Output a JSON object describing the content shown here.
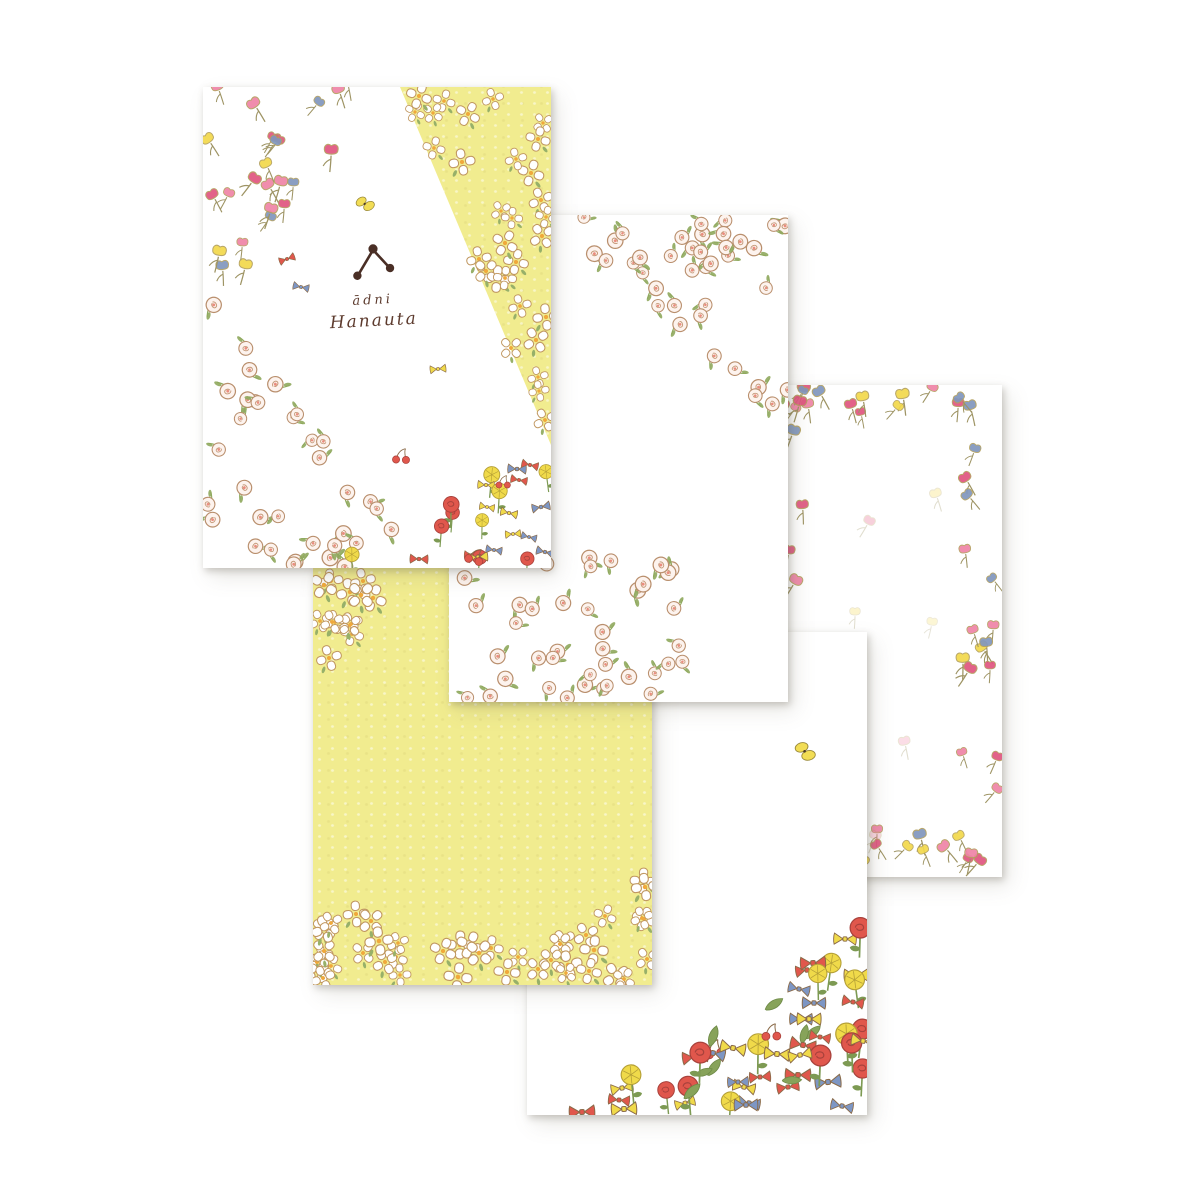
{
  "page": {
    "width": 1200,
    "height": 1200,
    "background": "#ffffff"
  },
  "brand": {
    "name_line1": "ādni",
    "name_line2": "Hanauta"
  },
  "palette": {
    "paper_yellow": "#f1ec8f",
    "text_brown": "#5d3b2e",
    "logo_brown": "#49senna",
    "outline_brown": "#b98f6d",
    "tulip_colors": [
      "#ef84a7",
      "#e0557f",
      "#f2d84b",
      "#8096bd"
    ],
    "bow_colors": [
      "#e0574c",
      "#f0da4a",
      "#7d96c4"
    ],
    "flower_red": "#e0574c",
    "flower_yellow": "#f0da4a",
    "leaf_green": "#8fa95d",
    "butterfly_yellow": "#f2dd55"
  },
  "cards": [
    {
      "id": "c1",
      "name": "letter-paper-main",
      "x": 203,
      "y": 87,
      "w": 348,
      "h": 481,
      "z": 5,
      "bg": "white"
    },
    {
      "id": "c2",
      "name": "letter-paper-rose-corners",
      "x": 449,
      "y": 215,
      "w": 339,
      "h": 487,
      "z": 4,
      "bg": "white"
    },
    {
      "id": "c3",
      "name": "letter-paper-tulip-border",
      "x": 772,
      "y": 385,
      "w": 230,
      "h": 492,
      "z": 1,
      "bg": "white"
    },
    {
      "id": "c4",
      "name": "letter-paper-yellow",
      "x": 313,
      "y": 567,
      "w": 339,
      "h": 418,
      "z": 3,
      "bg": "yellow"
    },
    {
      "id": "c5",
      "name": "letter-paper-flower-garden",
      "x": 527,
      "y": 632,
      "w": 340,
      "h": 483,
      "z": 2,
      "bg": "white"
    }
  ],
  "pattern_zones": [
    {
      "id": "c1-tulips",
      "card": "c1",
      "type": "tulip",
      "count": 24,
      "scale": 1.05,
      "seed": 11,
      "polygon": [
        [
          205,
          88
        ],
        [
          402,
          88
        ],
        [
          205,
          330
        ]
      ]
    },
    {
      "id": "c1-white-wedge-flowers",
      "card": "c1",
      "type": "whiteflower",
      "count": 30,
      "scale": 1.05,
      "seed": 12,
      "polygon": [
        [
          404,
          88
        ],
        [
          549,
          88
        ],
        [
          549,
          440
        ]
      ]
    },
    {
      "id": "c1-roses",
      "card": "c1",
      "type": "rose",
      "count": 34,
      "scale": 1.12,
      "seed": 13,
      "polygon": [
        [
          205,
          298
        ],
        [
          205,
          566
        ],
        [
          444,
          566
        ]
      ]
    },
    {
      "id": "c1-garden-corner",
      "card": "c1",
      "type": "garden",
      "count": 26,
      "scale": 0.85,
      "seed": 14,
      "polygon": [
        [
          549,
          444
        ],
        [
          549,
          566
        ],
        [
          335,
          566
        ]
      ]
    },
    {
      "id": "c2-roses-top-right",
      "card": "c2",
      "type": "rose",
      "count": 34,
      "scale": 1.1,
      "seed": 21,
      "polygon": [
        [
          552,
          217
        ],
        [
          786,
          217
        ],
        [
          786,
          428
        ]
      ]
    },
    {
      "id": "c2-roses-bottom-left",
      "card": "c2",
      "type": "rose",
      "count": 40,
      "scale": 1.1,
      "seed": 22,
      "polygon": [
        [
          449,
          558
        ],
        [
          665,
          558
        ],
        [
          700,
          655
        ],
        [
          700,
          700
        ],
        [
          449,
          700
        ]
      ]
    },
    {
      "id": "c3-border-top",
      "card": "c3",
      "type": "tulip",
      "count": 13,
      "scale": 1,
      "seed": 31,
      "polygon": [
        [
          782,
          390
        ],
        [
          1000,
          390
        ],
        [
          1000,
          424
        ],
        [
          782,
          424
        ]
      ]
    },
    {
      "id": "c3-border-right",
      "card": "c3",
      "type": "tulip",
      "count": 15,
      "scale": 1,
      "seed": 32,
      "polygon": [
        [
          962,
          394
        ],
        [
          998,
          394
        ],
        [
          998,
          866
        ],
        [
          962,
          866
        ]
      ]
    },
    {
      "id": "c3-border-bottom",
      "card": "c3",
      "type": "tulip",
      "count": 13,
      "scale": 1,
      "seed": 33,
      "polygon": [
        [
          782,
          834
        ],
        [
          1000,
          834
        ],
        [
          1000,
          868
        ],
        [
          782,
          868
        ]
      ]
    },
    {
      "id": "c3-border-left",
      "card": "c3",
      "type": "tulip",
      "count": 14,
      "scale": 1,
      "seed": 34,
      "polygon": [
        [
          774,
          394
        ],
        [
          808,
          394
        ],
        [
          808,
          866
        ],
        [
          774,
          866
        ]
      ]
    },
    {
      "id": "c4-corner-top-left",
      "card": "c4",
      "type": "whiteflower",
      "count": 13,
      "scale": 1.12,
      "seed": 41,
      "polygon": [
        [
          315,
          569
        ],
        [
          424,
          569
        ],
        [
          315,
          684
        ]
      ]
    },
    {
      "id": "c4-bottom-left-mound",
      "card": "c4",
      "type": "whiteflower",
      "count": 12,
      "scale": 1.12,
      "seed": 42,
      "polygon": [
        [
          315,
          858
        ],
        [
          432,
          983
        ],
        [
          315,
          983
        ]
      ]
    },
    {
      "id": "c4-bottom-strip",
      "card": "c4",
      "type": "whiteflower",
      "count": 20,
      "scale": 1.12,
      "seed": 43,
      "polygon": [
        [
          315,
          932
        ],
        [
          650,
          932
        ],
        [
          650,
          983
        ],
        [
          315,
          983
        ]
      ]
    },
    {
      "id": "c4-bottom-right-mound",
      "card": "c4",
      "type": "whiteflower",
      "count": 10,
      "scale": 1.12,
      "seed": 44,
      "polygon": [
        [
          650,
          862
        ],
        [
          650,
          983
        ],
        [
          545,
          983
        ]
      ]
    },
    {
      "id": "c5-garden-diagonal",
      "card": "c5",
      "type": "garden",
      "count": 56,
      "scale": 1.12,
      "seed": 51,
      "polygon": [
        [
          568,
          1113
        ],
        [
          865,
          922
        ],
        [
          865,
          1113
        ]
      ]
    }
  ],
  "accents": [
    {
      "card": "c1",
      "type": "bow",
      "x": 287,
      "y": 259,
      "rot": -20,
      "scale": 0.8,
      "color": "#e0574c"
    },
    {
      "card": "c1",
      "type": "bow",
      "x": 301,
      "y": 287,
      "rot": 12,
      "scale": 0.8,
      "color": "#7d96c4"
    },
    {
      "card": "c1",
      "type": "butterfly",
      "x": 366,
      "y": 204,
      "rot": -12,
      "scale": 0.85
    },
    {
      "card": "c1",
      "type": "bow",
      "x": 438,
      "y": 369,
      "rot": -6,
      "scale": 0.8,
      "color": "#f0da4a"
    },
    {
      "card": "c1",
      "type": "cherry",
      "x": 401,
      "y": 455,
      "rot": 0,
      "scale": 0.9
    },
    {
      "card": "c2",
      "type": "rose",
      "x": 700,
      "y": 318,
      "rot": 40,
      "scale": 1.1
    },
    {
      "card": "c2",
      "type": "rose",
      "x": 737,
      "y": 370,
      "rot": -30,
      "scale": 1.1
    },
    {
      "card": "c2",
      "type": "rose",
      "x": 756,
      "y": 398,
      "rot": 10,
      "scale": 1.1
    },
    {
      "card": "c2",
      "type": "rose",
      "x": 604,
      "y": 262,
      "rot": 80,
      "scale": 1.1
    },
    {
      "card": "c5",
      "type": "butterfly",
      "x": 806,
      "y": 752,
      "rot": 8,
      "scale": 1.0
    },
    {
      "card": "c3",
      "type": "tulip",
      "x": 938,
      "y": 500,
      "rot": -20,
      "scale": 1,
      "opacity": 0.3
    },
    {
      "card": "c3",
      "type": "tulip",
      "x": 866,
      "y": 527,
      "rot": 28,
      "scale": 1,
      "opacity": 0.3
    },
    {
      "card": "c3",
      "type": "tulip",
      "x": 855,
      "y": 618,
      "rot": 0,
      "scale": 0.9,
      "opacity": 0.3
    },
    {
      "card": "c3",
      "type": "tulip",
      "x": 931,
      "y": 628,
      "rot": 10,
      "scale": 0.9,
      "opacity": 0.25
    },
    {
      "card": "c3",
      "type": "tulip",
      "x": 906,
      "y": 748,
      "rot": -14,
      "scale": 1,
      "opacity": 0.3
    },
    {
      "card": "c3",
      "type": "tulip",
      "x": 873,
      "y": 842,
      "rot": 18,
      "scale": 1,
      "opacity": 0.35
    }
  ]
}
